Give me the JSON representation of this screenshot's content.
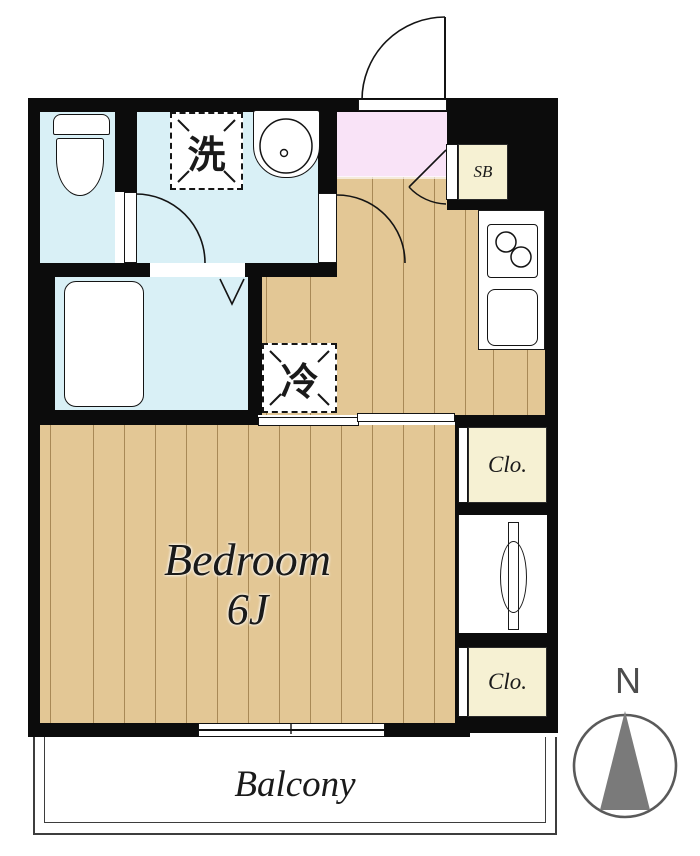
{
  "plan": {
    "type": "apartment-floorplan",
    "labels": {
      "washing_machine": "洗",
      "shoe_box": "SB",
      "refrigerator": "冷",
      "closet_upper": "Clo.",
      "closet_lower": "Clo.",
      "bedroom_name": "Bedroom",
      "bedroom_size": "6J",
      "balcony": "Balcony",
      "compass_north": "N"
    },
    "colors": {
      "wall": "#0c0c0c",
      "wet_area": "#d9f0f6",
      "wood_floor": "#e3c795",
      "entrance_floor": "#f9e3f7",
      "storage_fill": "#f6f1d3",
      "compass_gray": "#7a7a7a",
      "text": "#1a1a1a"
    }
  }
}
